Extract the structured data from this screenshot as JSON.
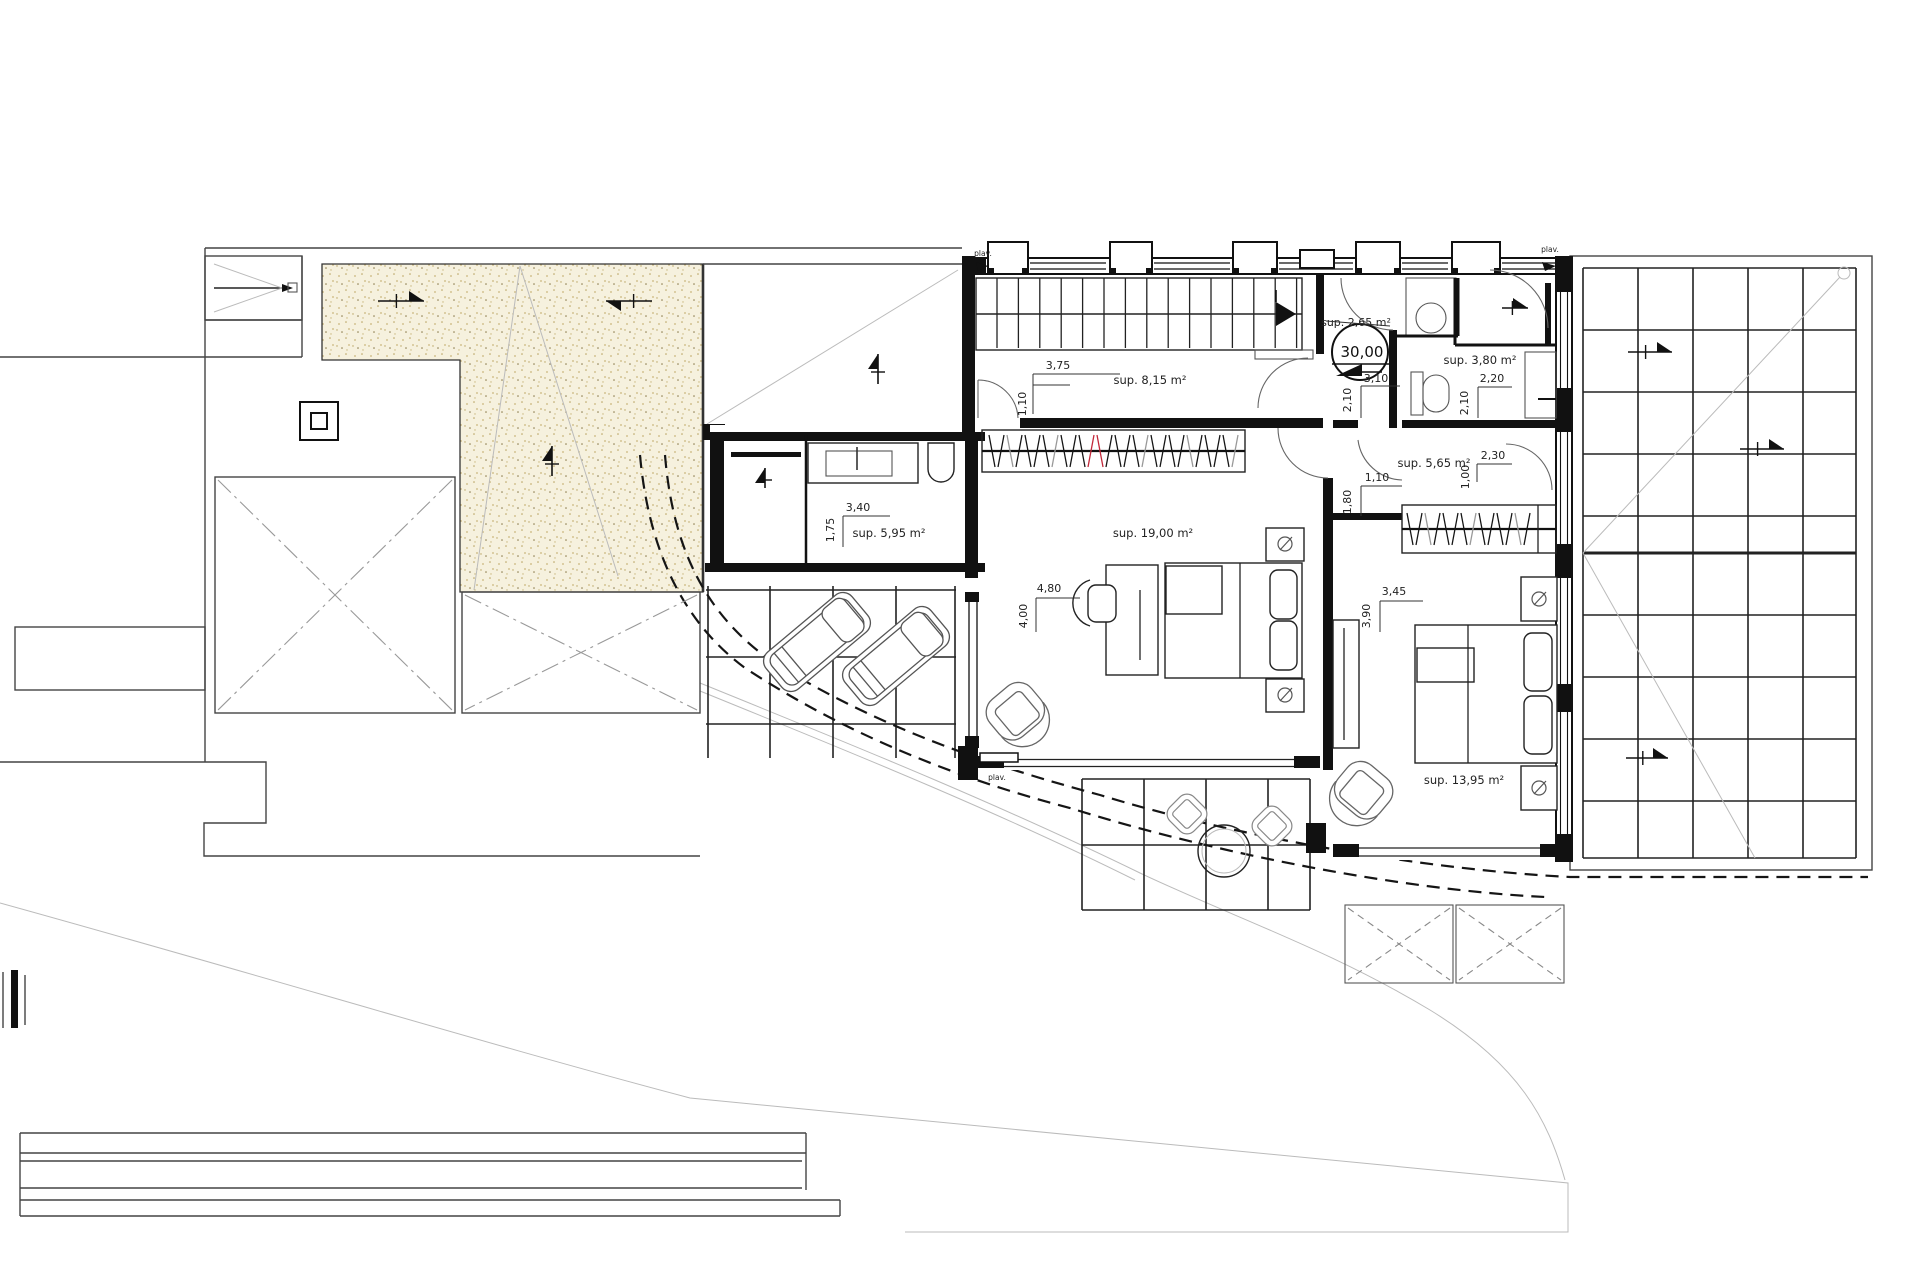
{
  "labels": {
    "plav": "plav.",
    "level_value": "30,00",
    "crossed_area": "sup. 2,65 m²"
  },
  "rooms": {
    "stair_hall": "sup. 8,15 m²",
    "bathroom": "sup. 3,80 m²",
    "hallway": "sup. 5,65 m²",
    "dressing": "sup. 5,95 m²",
    "master_bedroom": "s­up. 19,00 m²",
    "bedroom": "sup. 13,95 m²"
  },
  "dimensions": {
    "stair_width": "3,75",
    "stair_door": "1,10",
    "lobby_width": "3,10",
    "lobby_height": "2,10",
    "bathroom_width": "2,20",
    "bathroom_height": "2,10",
    "hall_right_width": "2,30",
    "hall_right_height": "1,00",
    "hall_left_width": "1,10",
    "hall_left_height": "1,80",
    "dressing_width": "3,40",
    "dressing_height": "1,75",
    "master_width": "4,80",
    "master_height": "4,00",
    "bedroom_width": "3,45",
    "bedroom_height": "3,90"
  }
}
